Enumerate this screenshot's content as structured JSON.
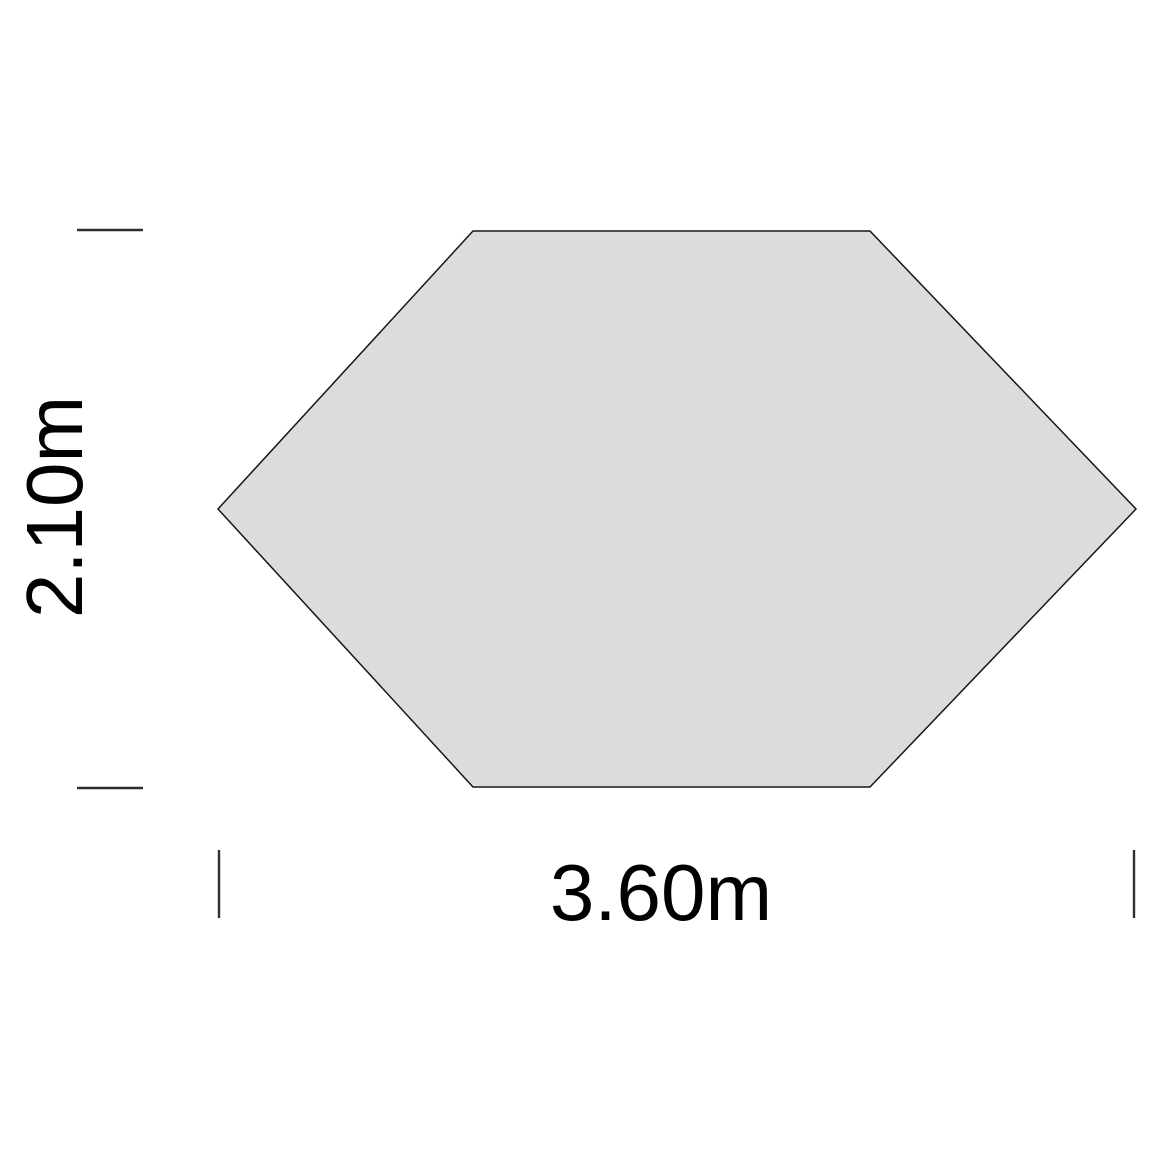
{
  "diagram": {
    "shape": "hexagon-footprint",
    "width_label": "3.60m",
    "height_label": "2.10m"
  },
  "colors": {
    "background": "#ffffff",
    "shape_fill": "#dcdcdc",
    "shape_outline": "#161616",
    "tick": "#2f2f2f",
    "text": "#000000"
  }
}
